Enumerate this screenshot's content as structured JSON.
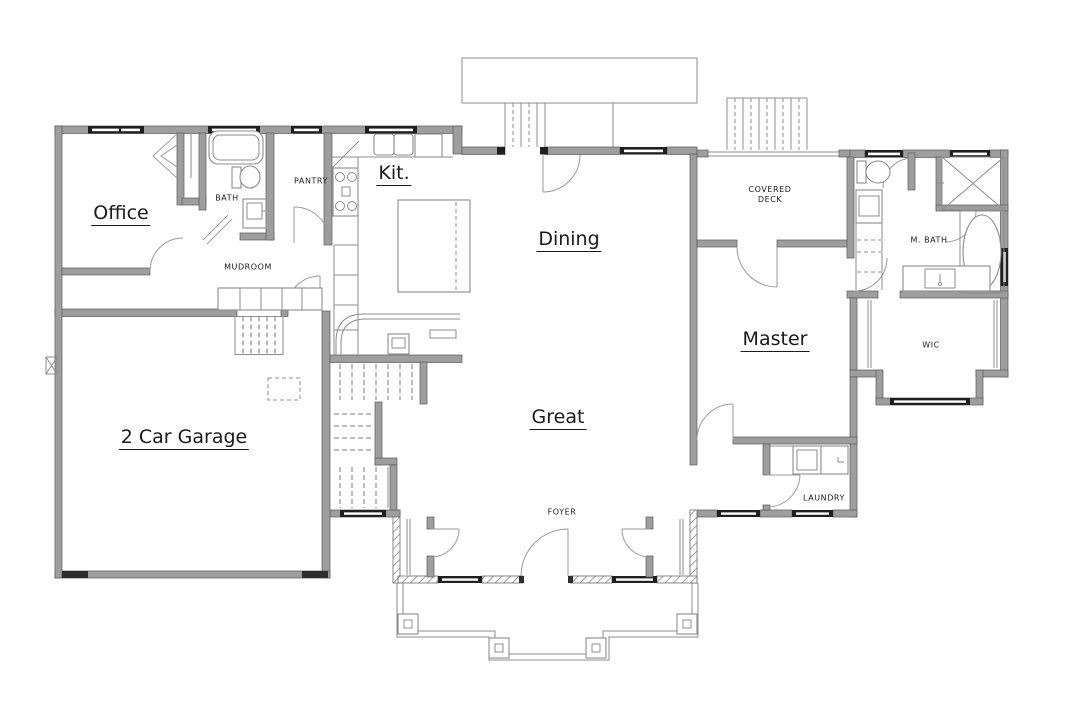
{
  "plan": {
    "rooms": {
      "office": "Office",
      "kitchen": "Kit.",
      "dining": "Dining",
      "garage": "2 Car Garage",
      "great": "Great",
      "master": "Master",
      "bath": "BATH",
      "pantry": "PANTRY",
      "mudroom": "MUDROOM",
      "foyer": "FOYER",
      "covered_deck_line1": "COVERED",
      "covered_deck_line2": "DECK",
      "master_bath": "M. BATH",
      "wic": "WIC",
      "laundry": "LAUNDRY"
    },
    "colors": {
      "wall": "#9e9e9e",
      "wall_edge": "#5a5a5a",
      "line": "#8c8c8c",
      "window": "#1f1f1f",
      "text": "#1a1a1a",
      "background": "#ffffff"
    }
  }
}
